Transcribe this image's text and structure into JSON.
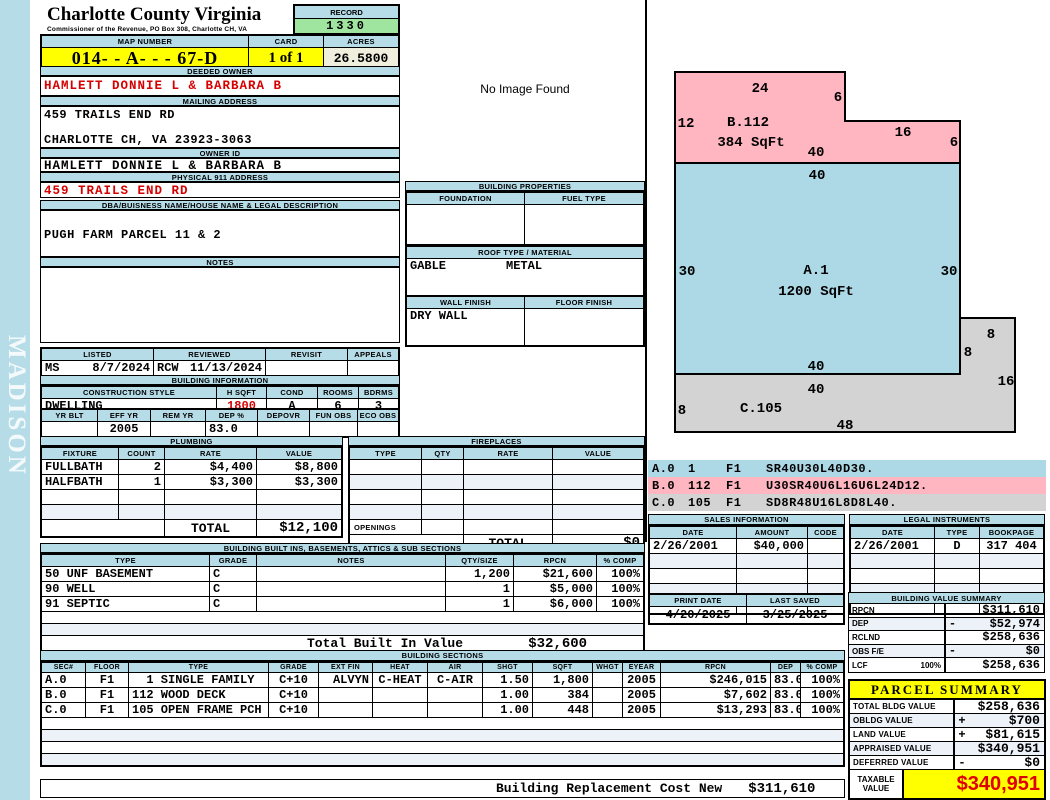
{
  "sidebar": {
    "label": "MADISON"
  },
  "header": {
    "county": "Charlotte County Virginia",
    "commissioner": "Commissioner of the Revenue, PO Box 308, Charlotte CH, VA",
    "record_label": "RECORD",
    "record": "1330",
    "map_label": "MAP NUMBER",
    "map": "014- - A- - - 67-D",
    "card_label": "CARD",
    "card": "1 of 1",
    "acres_label": "ACRES",
    "acres": "26.5800"
  },
  "owner": {
    "deeded_label": "DEEDED OWNER",
    "deeded": "HAMLETT DONNIE L & BARBARA B",
    "mailing_label": "MAILING ADDRESS",
    "mail1": "459 TRAILS END RD",
    "mail2": "CHARLOTTE CH, VA 23923-3063",
    "ownerid_label": "OWNER ID",
    "ownerid": "HAMLETT DONNIE L & BARBARA B",
    "physical_label": "PHYSICAL 911 ADDRESS",
    "physical": "459 TRAILS END RD",
    "dba_label": "DBA/BUISNESS NAME/HOUSE NAME & LEGAL DESCRIPTION",
    "dba": "PUGH FARM PARCEL 11 & 2",
    "notes_label": "NOTES",
    "notes": ""
  },
  "visits": {
    "listed_label": "LISTED",
    "reviewed_label": "REVIEWED",
    "revisit_label": "REVISIT",
    "appeals_label": "APPEALS",
    "listed_by": "MS",
    "listed_date": "8/7/2024",
    "reviewed_by": "RCW",
    "reviewed_date": "11/13/2024",
    "revisit": "",
    "appeals": ""
  },
  "building_info": {
    "title": "BUILDING INFORMATION",
    "style_label": "CONSTRUCTION STYLE",
    "style": "DWELLING",
    "hsqft_label": "H SQFT",
    "hsqft": "1800",
    "cond_label": "COND",
    "cond": "A",
    "rooms_label": "ROOMS",
    "rooms": "6",
    "bdrms_label": "BDRMS",
    "bdrms": "3",
    "yrblt_label": "YR BLT",
    "yrblt": "",
    "effyr_label": "EFF YR",
    "effyr": "2005",
    "remyr_label": "REM YR",
    "remyr": "",
    "dep_label": "DEP %",
    "dep": "83.0",
    "depovr_label": "DEPOVR",
    "depovr": "",
    "funobs_label": "FUN OBS",
    "funobs": "",
    "ecoobs_label": "ECO OBS",
    "ecoobs": ""
  },
  "plumbing": {
    "title": "PLUMBING",
    "headers": [
      "FIXTURE",
      "COUNT",
      "RATE",
      "VALUE"
    ],
    "rows": [
      {
        "fixture": "FULLBATH",
        "count": "2",
        "rate": "$4,400",
        "value": "$8,800"
      },
      {
        "fixture": "HALFBATH",
        "count": "1",
        "rate": "$3,300",
        "value": "$3,300"
      }
    ],
    "total_label": "TOTAL",
    "total": "$12,100"
  },
  "no_image": "No Image Found",
  "building_properties": {
    "title": "BUILDING PROPERTIES",
    "foundation_label": "FOUNDATION",
    "foundation": "",
    "fueltype_label": "FUEL TYPE",
    "fueltype": "",
    "roof_label": "ROOF TYPE / MATERIAL",
    "roof_type": "GABLE",
    "roof_material": "METAL",
    "wall_label": "WALL FINISH",
    "wall": "DRY WALL",
    "floor_label": "FLOOR FINISH",
    "floor": ""
  },
  "fireplaces": {
    "title": "FIREPLACES",
    "headers": [
      "TYPE",
      "QTY",
      "RATE",
      "VALUE"
    ],
    "openings_label": "OPENINGS",
    "total_label": "TOTAL",
    "total": "$0"
  },
  "built_ins": {
    "title": "BUILDING BUILT INS, BASEMENTS, ATTICS & SUB SECTIONS",
    "headers": [
      "TYPE",
      "GRADE",
      "NOTES",
      "QTY/SIZE",
      "RPCN",
      "% COMP"
    ],
    "rows": [
      {
        "type": "50 UNF BASEMENT",
        "grade": "C",
        "notes": "",
        "qty": "1,200",
        "rpcn": "$21,600",
        "comp": "100%"
      },
      {
        "type": "90 WELL",
        "grade": "C",
        "notes": "",
        "qty": "1",
        "rpcn": "$5,000",
        "comp": "100%"
      },
      {
        "type": "91 SEPTIC",
        "grade": "C",
        "notes": "",
        "qty": "1",
        "rpcn": "$6,000",
        "comp": "100%"
      }
    ],
    "total_label": "Total Built In Value",
    "total": "$32,600"
  },
  "sections": {
    "title": "BUILDING SECTIONS",
    "headers": [
      "SEC#",
      "FLOOR",
      "TYPE",
      "GRADE",
      "EXT FIN",
      "HEAT",
      "AIR",
      "SHGT",
      "SQFT",
      "WHGT",
      "EYEAR",
      "RPCN",
      "DEP",
      "% COMP"
    ],
    "rows": [
      {
        "sec": "A.0",
        "floor": "F1",
        "type": "  1 SINGLE FAMILY",
        "grade": "C+10",
        "extfin": "ALVYN",
        "heat": "C-HEAT",
        "air": "C-AIR",
        "shgt": "1.50",
        "sqft": "1,800",
        "whgt": "",
        "eyear": "2005",
        "rpcn": "$246,015",
        "dep": "83.0",
        "comp": "100%"
      },
      {
        "sec": "B.0",
        "floor": "F1",
        "type": "112 WOOD DECK",
        "grade": "C+10",
        "extfin": "",
        "heat": "",
        "air": "",
        "shgt": "1.00",
        "sqft": "384",
        "whgt": "",
        "eyear": "2005",
        "rpcn": "$7,602",
        "dep": "83.0",
        "comp": "100%"
      },
      {
        "sec": "C.0",
        "floor": "F1",
        "type": "105 OPEN FRAME PCH",
        "grade": "C+10",
        "extfin": "",
        "heat": "",
        "air": "",
        "shgt": "1.00",
        "sqft": "448",
        "whgt": "",
        "eyear": "2005",
        "rpcn": "$13,293",
        "dep": "83.0",
        "comp": "100%"
      }
    ],
    "replacement_label": "Building Replacement Cost New",
    "replacement": "$311,610"
  },
  "sketch": {
    "a_label": "A.1",
    "a_sqft": "1200 SqFt",
    "b_label": "B.112",
    "b_sqft": "384 SqFt",
    "c_label": "C.105",
    "dims": {
      "b_top": "24",
      "b_step": "6",
      "b_left": "12",
      "b_mid": "16",
      "b_right": "6",
      "b_bottom": "40",
      "a_top": "40",
      "a_left": "30",
      "a_right": "30",
      "a_bottom": "40",
      "c_top": "40",
      "c_left": "8",
      "c_bottom": "48",
      "c_tab_top": "8",
      "c_tab_left": "8",
      "c_tab_right": "16"
    },
    "codes": [
      {
        "sec": "A.0",
        "num": "1",
        "floor": "F1",
        "trace": "SR40U30L40D30."
      },
      {
        "sec": "B.0",
        "num": "112",
        "floor": "F1",
        "trace": "U30SR40U6L16U6L24D12."
      },
      {
        "sec": "C.0",
        "num": "105",
        "floor": "F1",
        "trace": "SD8R48U16L8D8L40."
      }
    ]
  },
  "sales": {
    "title": "SALES INFORMATION",
    "headers": [
      "DATE",
      "AMOUNT",
      "CODE"
    ],
    "rows": [
      {
        "date": "2/26/2001",
        "amount": "$40,000",
        "code": ""
      }
    ]
  },
  "legal": {
    "title": "LEGAL INSTRUMENTS",
    "headers": [
      "DATE",
      "TYPE",
      "BOOKPAGE"
    ],
    "rows": [
      {
        "date": "2/26/2001",
        "type": "D",
        "bookpage": "317 404"
      }
    ]
  },
  "dates": {
    "print_label": "PRINT DATE",
    "print": "4/20/2025",
    "saved_label": "LAST SAVED",
    "saved": "3/25/2025"
  },
  "value_summary": {
    "title": "BUILDING VALUE SUMMARY",
    "rows": [
      {
        "label": "RPCN",
        "pct": "",
        "op": "",
        "value": "$311,610"
      },
      {
        "label": "DEP",
        "pct": "",
        "op": "-",
        "value": "$52,974"
      },
      {
        "label": "RCLND",
        "pct": "",
        "op": "",
        "value": "$258,636"
      },
      {
        "label": "OBS F/E",
        "pct": "",
        "op": "-",
        "value": "$0"
      },
      {
        "label": "LCF",
        "pct": "100%",
        "op": "",
        "value": "$258,636"
      }
    ]
  },
  "parcel_summary": {
    "title": "PARCEL SUMMARY",
    "rows": [
      {
        "label": "TOTAL BLDG VALUE",
        "op": "",
        "value": "$258,636"
      },
      {
        "label": "OBLDG VALUE",
        "op": "+",
        "value": "$700"
      },
      {
        "label": "LAND VALUE",
        "op": "+",
        "value": "$81,615"
      },
      {
        "label": "APPRAISED VALUE",
        "op": "",
        "value": "$340,951"
      },
      {
        "label": "DEFERRED VALUE",
        "op": "-",
        "value": "$0"
      }
    ],
    "taxable_label": "TAXABLE VALUE",
    "taxable": "$340,951"
  },
  "colors": {
    "header_blue": "#b6dce8",
    "record_green": "#9fe49f",
    "highlight_yellow": "#ffff00",
    "acres_cream": "#f0eedd",
    "alert_red": "#d60000",
    "sketch_pink": "#ffb6c1",
    "sketch_blue": "#add8e6",
    "sketch_gray": "#d3d3d3"
  }
}
